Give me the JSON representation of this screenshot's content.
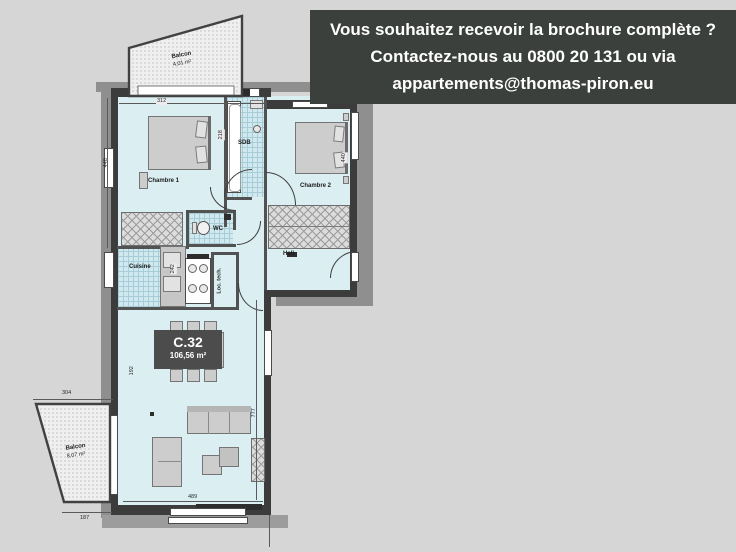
{
  "banner": {
    "line1": "Vous souhaitez recevoir la brochure complète ?",
    "line2": "Contactez-nous au 0800 20 131 ou via",
    "line3": "appartements@thomas-piron.eu"
  },
  "unit": {
    "code": "C.32",
    "area": "106,56 m²"
  },
  "rooms": {
    "chambre1": "Chambre 1",
    "chambre2": "Chambre 2",
    "sdb": "SDB",
    "wc": "WC",
    "cuisine": "Cuisine",
    "hall": "Hall",
    "loc_tech": "Loc. tech."
  },
  "balconies": {
    "top": {
      "label": "Balcon",
      "area": "4,01 m²"
    },
    "bottom": {
      "label": "Balcon",
      "area": "8,07 m²"
    }
  },
  "dims": {
    "top": "312",
    "left_upper": "448",
    "left_lower": "192",
    "right_upper": "440",
    "living_height": "777",
    "living_width": "489",
    "balcony_top_width": "304",
    "balcony_bottom_width": "187",
    "balcony_side": "330",
    "kitchen": "242",
    "sdb": "218"
  },
  "colors": {
    "background": "#d6d6d6",
    "banner_bg": "#3b403c",
    "banner_text": "#ffffff",
    "room_fill": "#dbeef2",
    "wall": "#3c3c3c",
    "badge_bg": "#4c4c4c",
    "balcony_fill": "#efefef",
    "tile_line": "#a8cdd8"
  }
}
